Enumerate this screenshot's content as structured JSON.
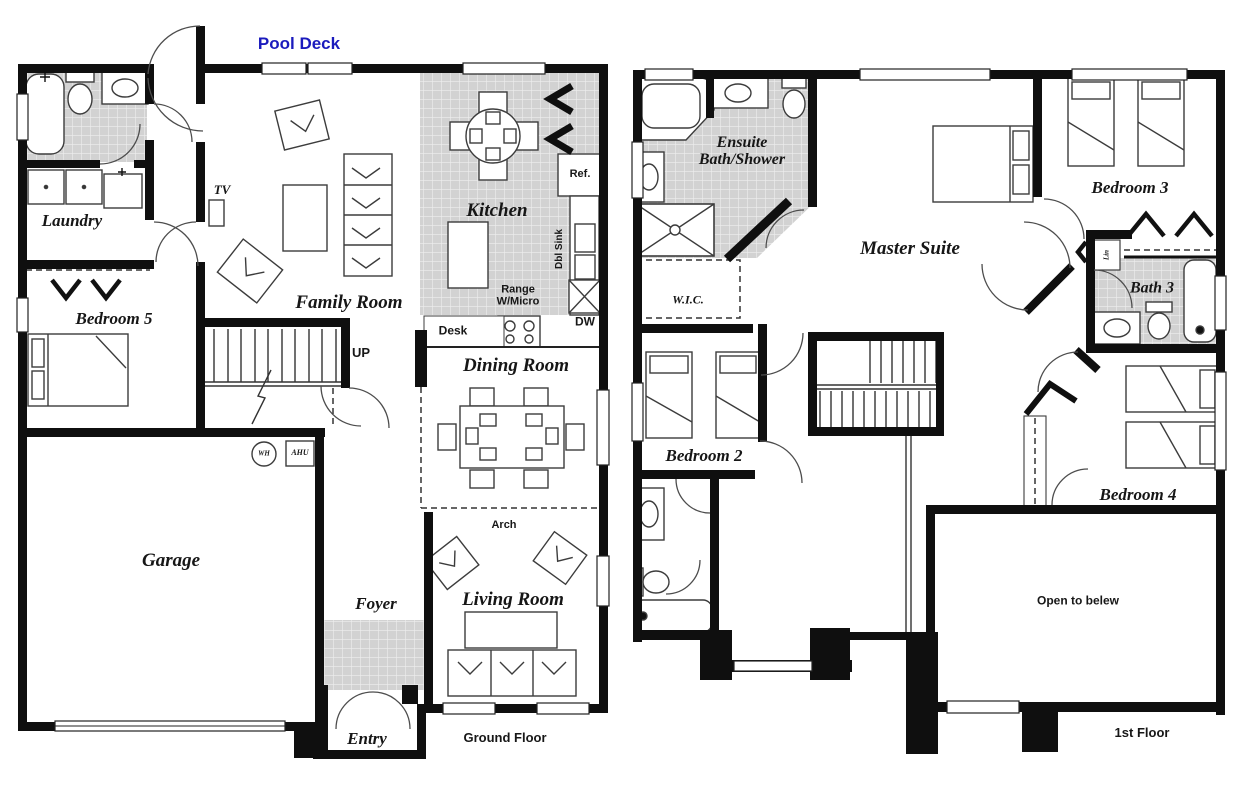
{
  "colors": {
    "wall": "#0f0f0f",
    "tile_fill": "#d2d2d2",
    "tile_grout": "#efefef",
    "pool_deck_text": "#1b1bbd",
    "label_ink": "#161616"
  },
  "ground_floor": {
    "floor_label": "Ground Floor",
    "outdoor_label": "Pool Deck",
    "rooms": {
      "laundry": "Laundry",
      "bedroom5": "Bedroom 5",
      "family_room": "Family Room",
      "kitchen": "Kitchen",
      "dining_room": "Dining Room",
      "garage": "Garage",
      "foyer": "Foyer",
      "living_room": "Living Room",
      "entry": "Entry"
    },
    "annotations": {
      "tv": "TV",
      "ref": "Ref.",
      "dbl_sink": "Dbl Sink",
      "range_micro": "Range W/Micro",
      "desk": "Desk",
      "dw": "DW",
      "up": "UP",
      "arch": "Arch",
      "water_heater": "WH",
      "air_handler": "AHU"
    }
  },
  "first_floor": {
    "floor_label": "1st Floor",
    "rooms": {
      "ensuite": "Ensuite Bath/Shower",
      "master_suite": "Master Suite",
      "bedroom2": "Bedroom 2",
      "bedroom3": "Bedroom 3",
      "bedroom4": "Bedroom 4",
      "bath3": "Bath 3",
      "wic": "W.I.C."
    },
    "annotations": {
      "linen": "Lin",
      "open_to_below": "Open to belew"
    }
  }
}
